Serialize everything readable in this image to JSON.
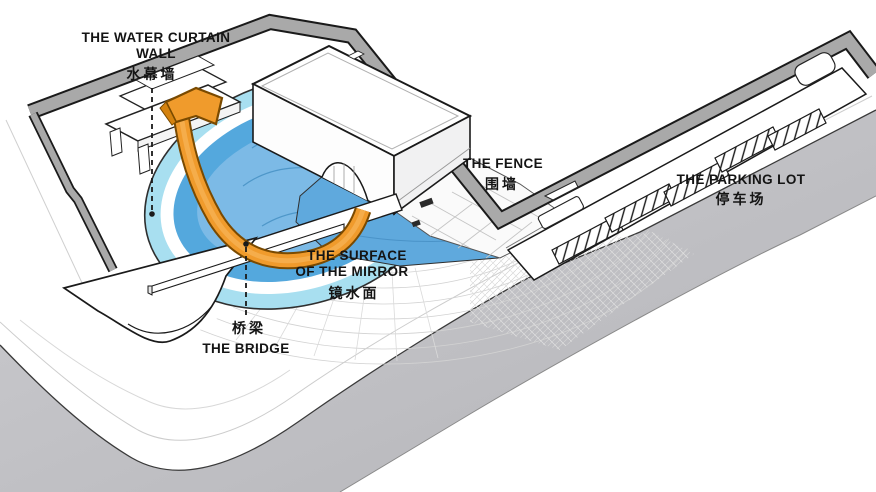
{
  "diagram": {
    "kind": "axonometric-site-diagram",
    "labels": {
      "water_curtain_wall": {
        "en_line1": "THE WATER CURTAIN",
        "en_line2": "WALL",
        "zh": "水幕墙"
      },
      "fence": {
        "en": "THE FENCE",
        "zh": "围墙"
      },
      "parking_lot": {
        "en": "THE PARKING LOT",
        "zh": "停车场"
      },
      "mirror_surface": {
        "en_line1": "THE SURFACE",
        "en_line2": "OF THE MIRROR",
        "zh": "镜水面"
      },
      "bridge": {
        "en": "THE BRIDGE",
        "zh": "桥梁"
      }
    },
    "colors": {
      "pool_ring_outer": "#a8dff0",
      "pool_ring_mid": "#54a8dd",
      "pool_inner": "#7cbae6",
      "water_flat": "#5fa9dd",
      "arrow_orange": "#f09b2c",
      "arrow_outline": "#7a4a00",
      "wall_gray": "#a9a9a9",
      "road_gray": "#c3c3c8",
      "label_text": "#141414"
    }
  }
}
